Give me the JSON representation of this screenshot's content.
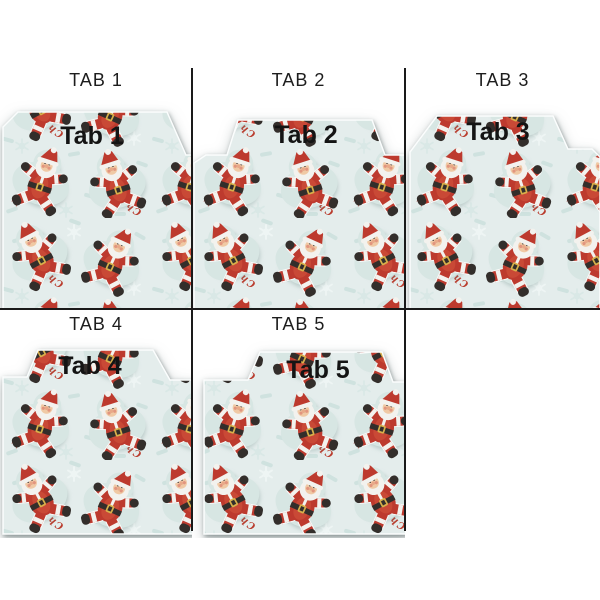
{
  "cells": [
    {
      "label": "TAB 1",
      "tab_text": "Tab 1"
    },
    {
      "label": "TAB 2",
      "tab_text": "Tab 2"
    },
    {
      "label": "TAB 3",
      "tab_text": "Tab 3"
    },
    {
      "label": "TAB 4",
      "tab_text": "Tab 4"
    },
    {
      "label": "TAB 5",
      "tab_text": "Tab 5"
    }
  ],
  "pattern": {
    "name": "santa-merry-christmas",
    "texts": {
      "merry": "Merry",
      "christmas": "Christmas"
    },
    "colors": {
      "background": "#e4edec",
      "imprint": "#d7e6e3",
      "santa_red": "#bd3a2e",
      "santa_red_light": "#c94936",
      "fur_white": "#f3f2ee",
      "boot_black": "#332e2b",
      "belt_gold": "#d8b04a",
      "script_red": "#b93b2c"
    }
  },
  "grid": {
    "border_color": "#1a1a1a"
  }
}
